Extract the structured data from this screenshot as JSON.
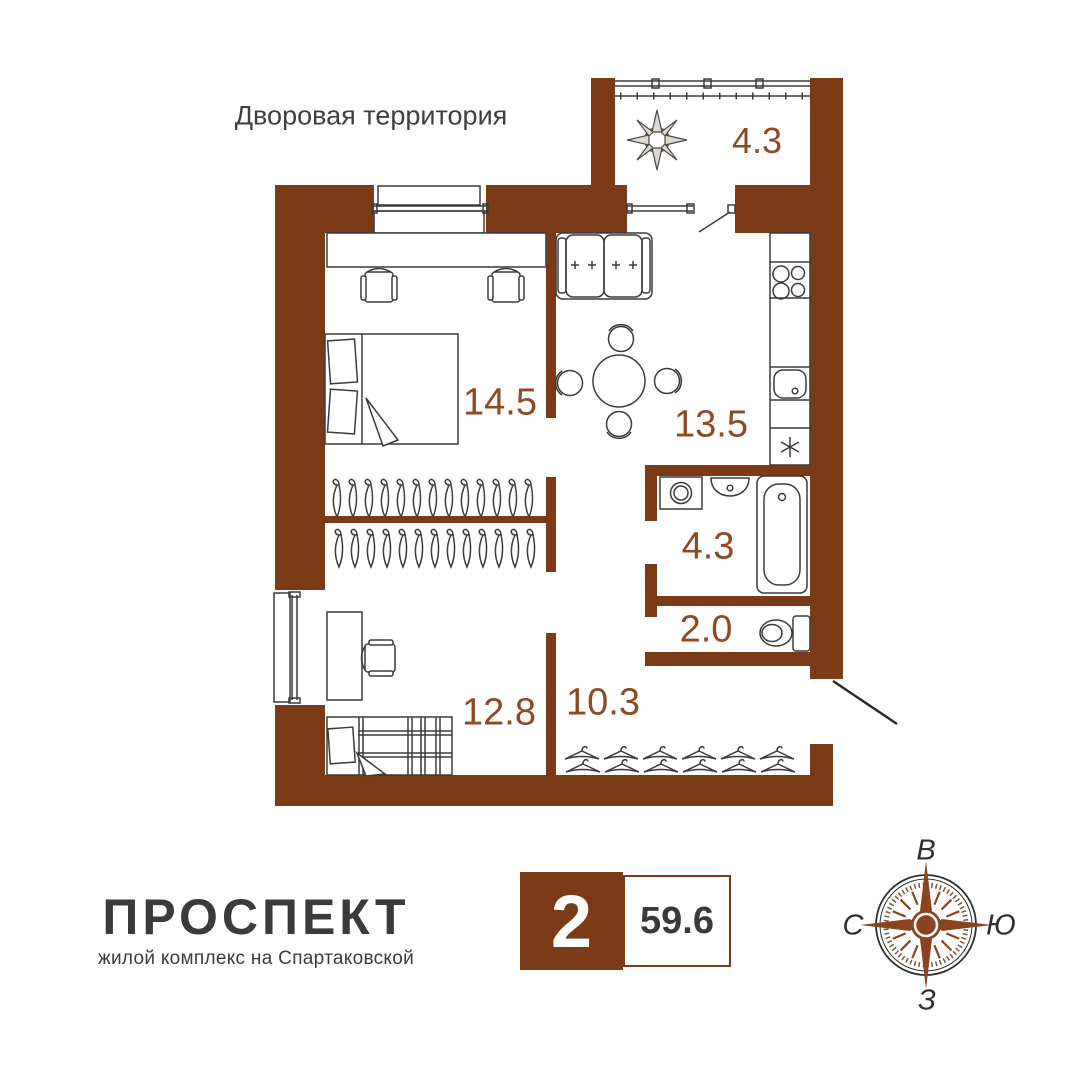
{
  "title": "Дворовая территория",
  "rooms": {
    "balcony": {
      "area": "4.3"
    },
    "bedroom": {
      "area": "14.5"
    },
    "kitchen_living": {
      "area": "13.5"
    },
    "bathroom": {
      "area": "4.3"
    },
    "wc": {
      "area": "2.0"
    },
    "bedroom2": {
      "area": "12.8"
    },
    "hallway": {
      "area": "10.3"
    }
  },
  "badge": {
    "rooms_count": "2",
    "total_area": "59.6"
  },
  "logo": {
    "name": "ПРОСПЕКТ",
    "tagline": "жилой комплекс на Спартаковской"
  },
  "compass": {
    "top": "В",
    "left": "С",
    "right": "Ю",
    "bottom": "З"
  },
  "colors": {
    "wall": "#7b3a16",
    "area_label": "#8f4a24",
    "text_dark": "#3b3b3d",
    "compass_rose": "#8a4520"
  },
  "icons": {
    "plant": "eight-petal-flower",
    "compass": "compass-rose",
    "entrance": "door-swing-line"
  }
}
